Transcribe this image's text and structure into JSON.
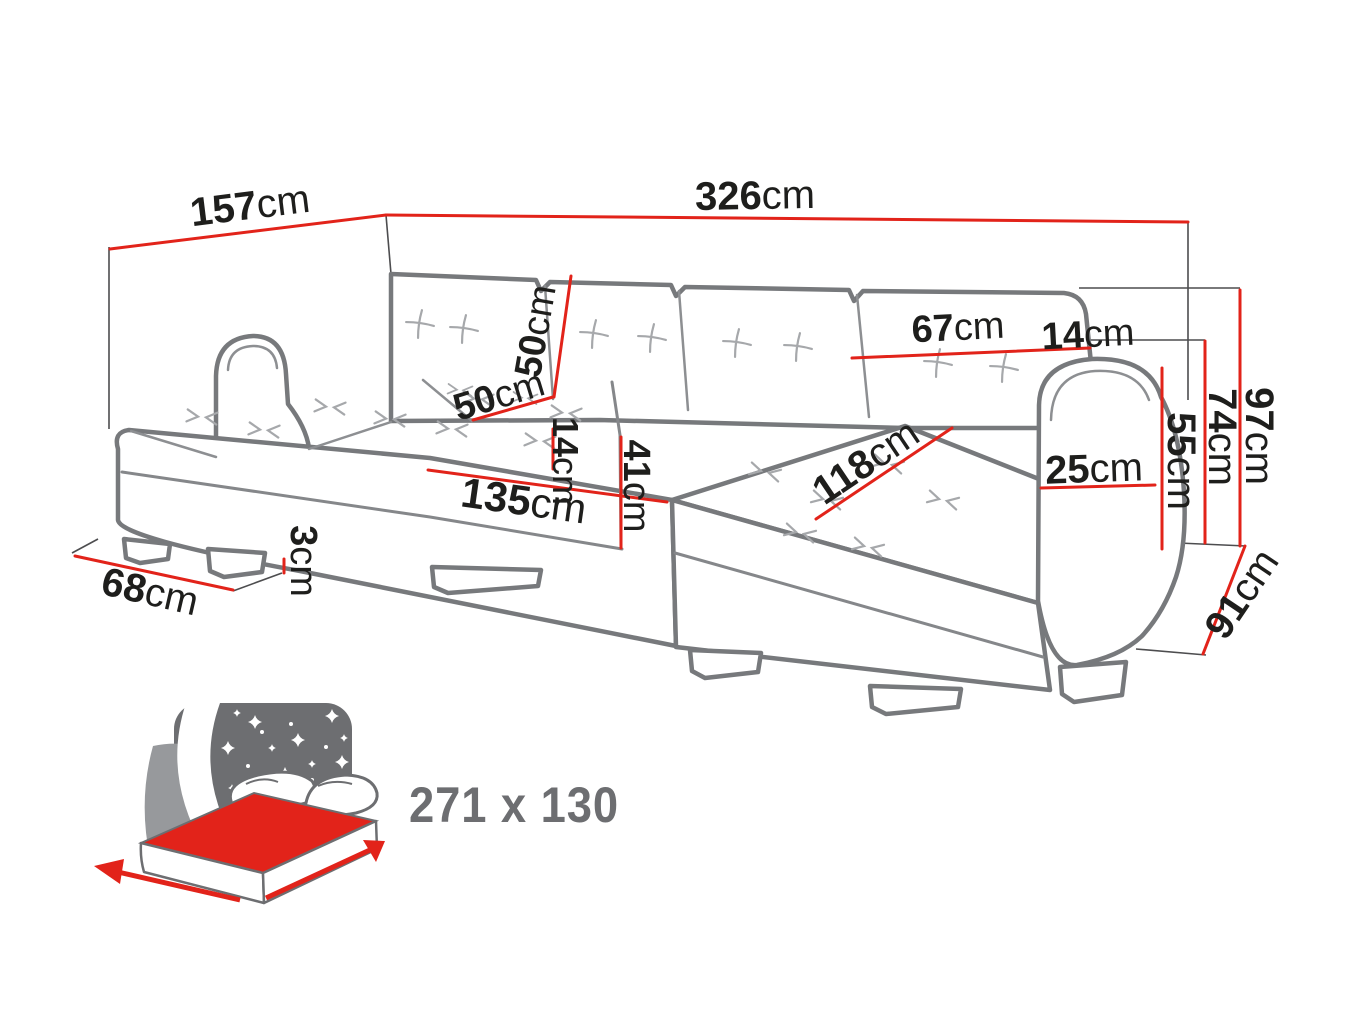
{
  "palette": {
    "dimension_red": "#e2231a",
    "sofa_outline_gray": "#77797c",
    "thin_line_gray": "#4d4d4f",
    "detail_light_gray": "#a6a8ab",
    "label_black": "#1e1e1c",
    "icon_gray": "#6d6e71"
  },
  "diagram": {
    "subject": "u-shaped-corner-sofa-dimension-drawing"
  },
  "dimensions": [
    {
      "id": "side-depth-top",
      "value": "157",
      "unit": "cm"
    },
    {
      "id": "total-width-top",
      "value": "326",
      "unit": "cm"
    },
    {
      "id": "back-cushion-width",
      "value": "67",
      "unit": "cm"
    },
    {
      "id": "back-gap-width",
      "value": "14",
      "unit": "cm"
    },
    {
      "id": "backrest-height",
      "value": "50",
      "unit": "cm"
    },
    {
      "id": "seat-depth",
      "value": "50",
      "unit": "cm"
    },
    {
      "id": "seat-thickness",
      "value": "14",
      "unit": "cm"
    },
    {
      "id": "seat-height",
      "value": "41",
      "unit": "cm"
    },
    {
      "id": "front-width",
      "value": "135",
      "unit": "cm"
    },
    {
      "id": "chaise-length",
      "value": "118",
      "unit": "cm"
    },
    {
      "id": "armrest-width",
      "value": "25",
      "unit": "cm"
    },
    {
      "id": "armrest-height",
      "value": "55",
      "unit": "cm"
    },
    {
      "id": "back-height",
      "value": "74",
      "unit": "cm"
    },
    {
      "id": "total-height",
      "value": "97",
      "unit": "cm"
    },
    {
      "id": "side-depth-right",
      "value": "91",
      "unit": "cm"
    },
    {
      "id": "chaise-end-width",
      "value": "68",
      "unit": "cm"
    },
    {
      "id": "leg-height",
      "value": "3",
      "unit": "cm"
    }
  ],
  "bed": {
    "sleeping_size": "271 x 130"
  }
}
